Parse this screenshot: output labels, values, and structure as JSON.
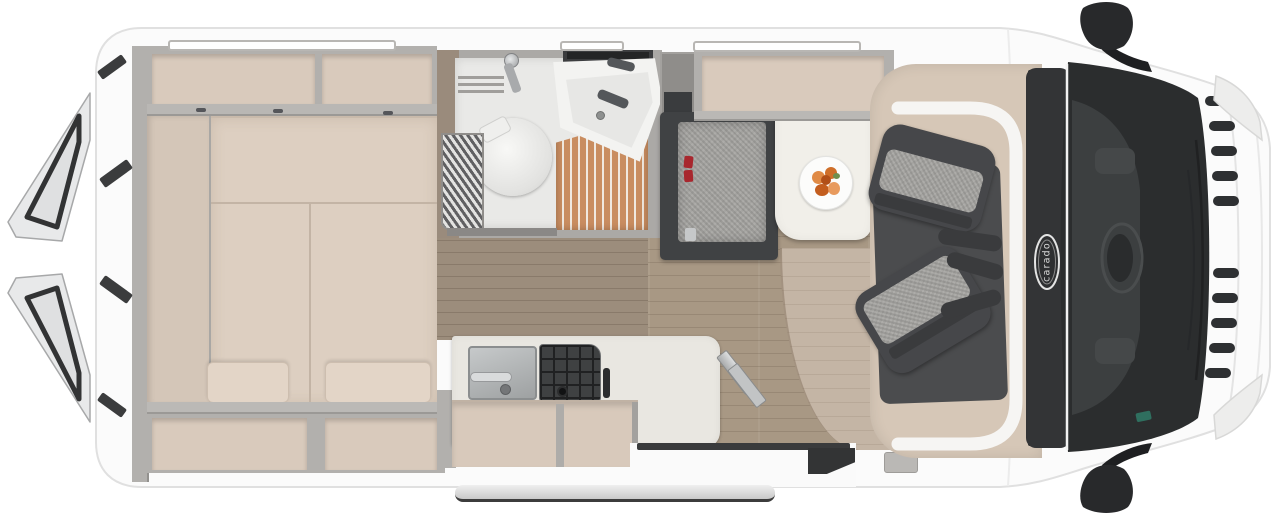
{
  "brand": {
    "label": "carado",
    "badge": "oval-hood-badge"
  },
  "scene": {
    "type": "motorhome-floorplan-top-view",
    "vehicle": "camper van",
    "view": "top-down",
    "front_of_vehicle": "right",
    "rear_of_vehicle": "left (rear doors shown open)"
  },
  "areas": {
    "rear_bedroom": [
      "transverse double bed with split mattress cushions",
      "two backrest wedge cushions",
      "overhead storage lockers",
      "under-bed storage compartments",
      "side shelf at rear doors"
    ],
    "bathroom": [
      "cassette toilet",
      "corner washbasin with faucets",
      "wooden shower grate floor",
      "pleated shower screen",
      "roof vent"
    ],
    "kitchen": [
      "stainless steel sink with faucet",
      "gas hob with black grid",
      "L-shaped worktop",
      "beige cabinet fronts"
    ],
    "dinette": [
      "side bench seat with red seatbelt buckles",
      "pedestal table",
      "plate with fruit",
      "overhead locker"
    ],
    "cab": [
      "driver swivel seat",
      "passenger swivel seat",
      "dark floor mat",
      "dashboard",
      "windshield",
      "two side mirrors",
      "front grille slats",
      "headlights",
      "carado hood badge"
    ],
    "entry": [
      "sliding door opening",
      "folding entry step",
      "exterior running board",
      "interior step"
    ]
  },
  "colors": {
    "body_white": "#fbfbfb",
    "outline_gray": "#e0e0e0",
    "wall_gray": "#b2b0ad",
    "locker_beige": "#d9cabc",
    "mattress": "#ddcfc1",
    "cushion": "#e3d5c7",
    "wood_floor": "#a89884",
    "wood_floor_light": "#c4b5a5",
    "wood_wall": "#9a8b7c",
    "bath_floor": "#e9e9e7",
    "shower_wood": "#c98d60",
    "fixture_white": "#f3f3f1",
    "steel": "#b9bcbd",
    "hob_dark": "#3f4142",
    "counter": "#e9e7e1",
    "cabinet_beige": "#d8c9bb",
    "table_white": "#f1efe9",
    "plate_orange": "#df8243",
    "bench_dark": "#404244",
    "tweed_gray": "#a5a4a1",
    "seat_dark": "#46474a",
    "mat_dark": "#4b4c4e",
    "cab_beige": "#d6c7b7",
    "dash_dark": "#333436",
    "glass_dark": "#2b2d2e",
    "mirror_dark": "#28292b",
    "red_accent": "#a8272e"
  }
}
